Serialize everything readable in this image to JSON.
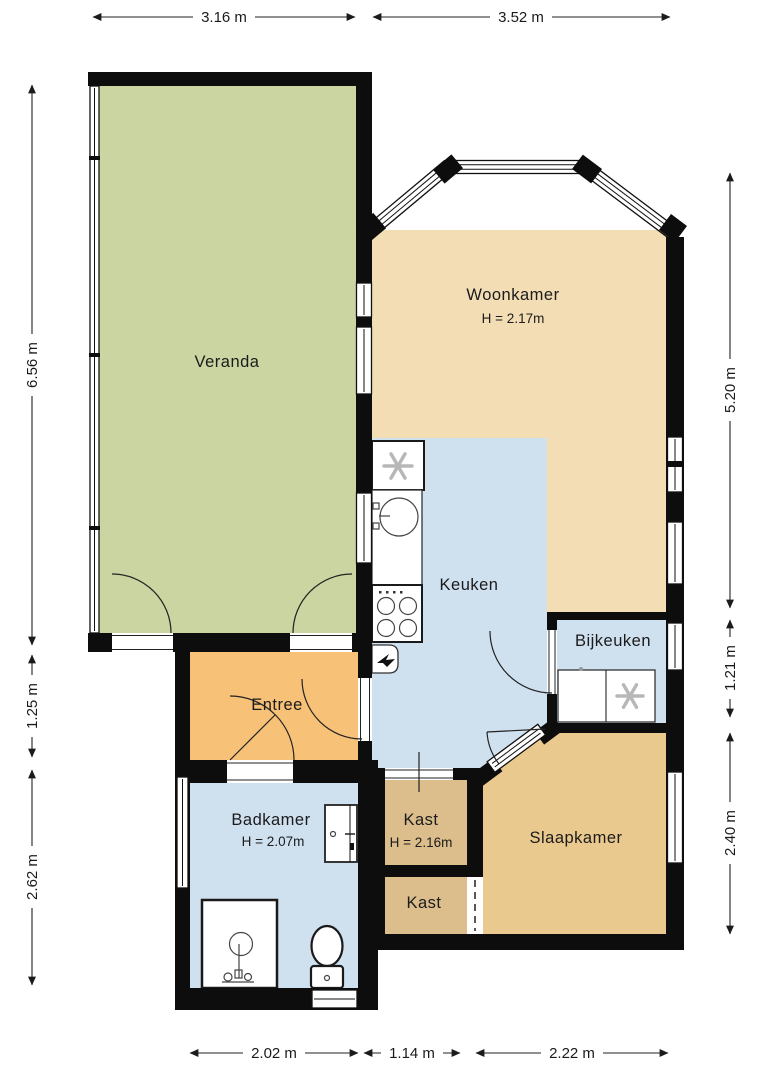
{
  "title": "Floor plan",
  "colors": {
    "veranda": "#cad5a2",
    "woonkamer": "#f3ddb5",
    "keuken": "#cfe0ef",
    "bijkeuken": "#cfe0ef",
    "badkamer": "#cfe0ef",
    "entree": "#f7c278",
    "slaapkamer": "#eac98f",
    "kast": "#dcbe8d",
    "wall": "#0d0d0d",
    "text": "#1b1b1b"
  },
  "rooms": {
    "veranda": {
      "label": "Veranda"
    },
    "woonkamer": {
      "label": "Woonkamer",
      "height": "H = 2.17m"
    },
    "keuken": {
      "label": "Keuken"
    },
    "bijkeuken": {
      "label": "Bijkeuken"
    },
    "entree": {
      "label": "Entree"
    },
    "badkamer": {
      "label": "Badkamer",
      "height": "H = 2.07m"
    },
    "kast1": {
      "label": "Kast",
      "height": "H = 2.16m"
    },
    "kast2": {
      "label": "Kast"
    },
    "slaapkamer": {
      "label": "Slaapkamer"
    }
  },
  "dimensions": {
    "top": [
      "3.16 m",
      "3.52 m"
    ],
    "bottom": [
      "2.02 m",
      "1.14 m",
      "2.22 m"
    ],
    "left": [
      "6.56 m",
      "1.25 m",
      "2.62 m"
    ],
    "right": [
      "5.20 m",
      "1.21 m",
      "2.40 m"
    ]
  },
  "icons": {
    "fridge": "snowflake-icon",
    "washing_machine": "snowflake-icon",
    "stove": "four-burner-stove-icon",
    "sink": "round-sink-icon",
    "boiler": "boiler-icon",
    "shower": "shower-icon",
    "toilet": "toilet-icon"
  }
}
